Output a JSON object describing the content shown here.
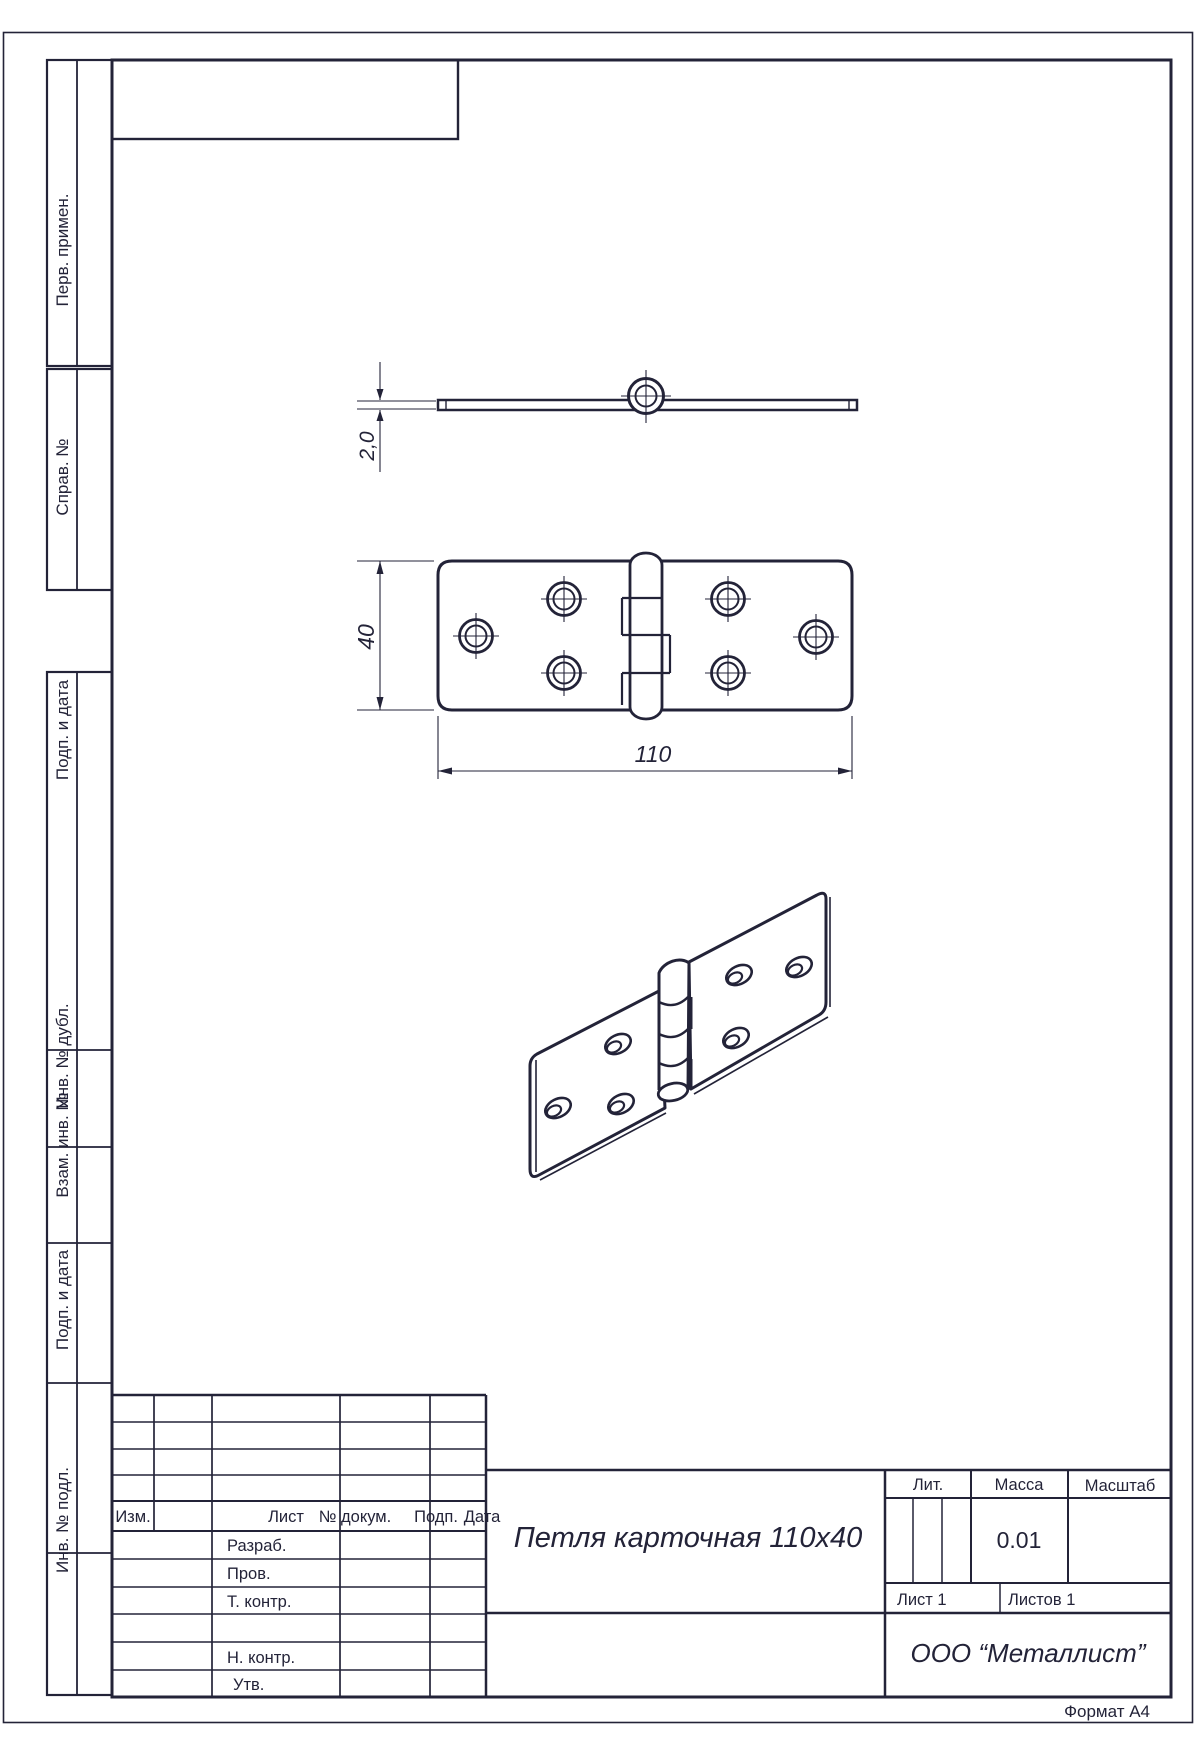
{
  "colors": {
    "ink": "#232338",
    "paper": "#ffffff"
  },
  "margin_labels": [
    "Перв. примен.",
    "Справ. №",
    "Подп. и дата",
    "Инв. № дубл.",
    "Взам. инв. №",
    "Подп. и дата",
    "Инв. № подл."
  ],
  "drawing": {
    "part": "card hinge",
    "dim_thickness": "2,0",
    "dim_height": "40",
    "dim_length": "110"
  },
  "title_block": {
    "header": {
      "izm": "Изм.",
      "list": "Лист",
      "doc": "№ докум.",
      "podp": "Подп.",
      "data": "Дата"
    },
    "rows": [
      "Разраб.",
      "Пров.",
      "Т. контр.",
      "Н. контр.",
      "Утв."
    ],
    "title": "Петля карточная 110x40",
    "lit_label": "Лит.",
    "mass_label": "Масса",
    "scale_label": "Масштаб",
    "mass_value": "0.01",
    "sheet_label": "Лист 1",
    "sheets_label": "Листов 1",
    "company": "ООО “Металлист”",
    "format": "Формат А4"
  }
}
